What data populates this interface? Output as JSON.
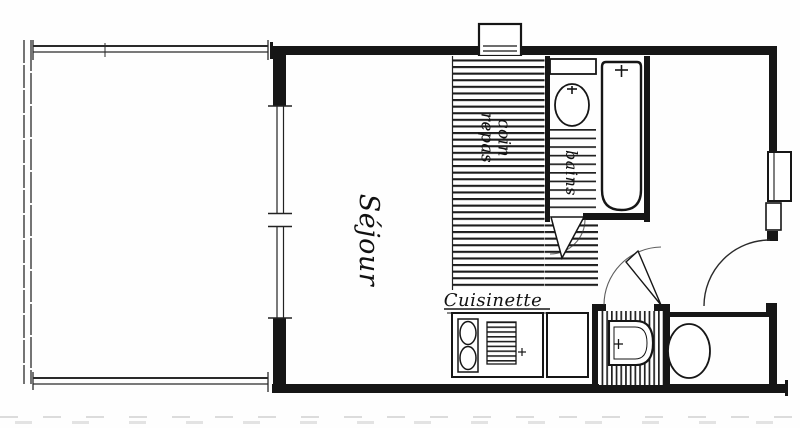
{
  "plan": {
    "title": "studio floor plan (scanned)",
    "rooms": {
      "sejour": {
        "label": "Séjour"
      },
      "coin_repas": {
        "label": "coin repas"
      },
      "bains": {
        "label": "bains"
      },
      "cuisinette": {
        "label": "Cuisinette"
      }
    },
    "colors": {
      "ink": "#161616",
      "paper": "#fefefe"
    }
  }
}
